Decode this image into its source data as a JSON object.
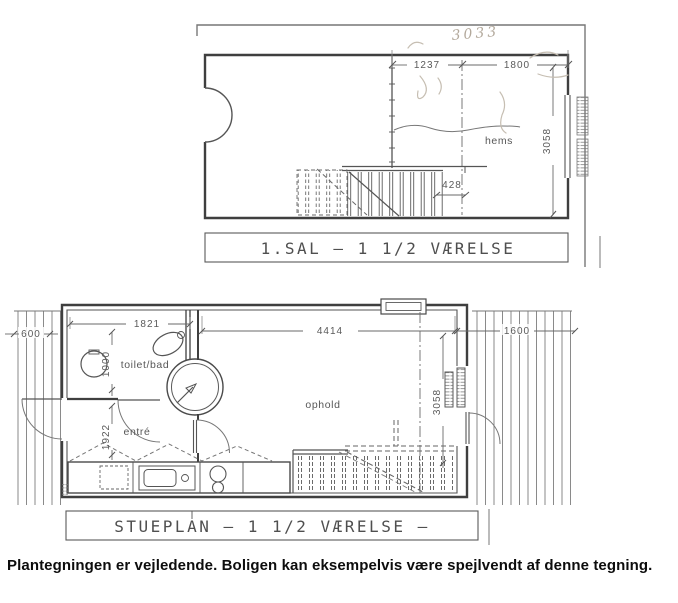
{
  "page": {
    "caption": "Plantegningen er vejledende. Boligen kan eksempelvis være spejlvendt af denne tegning.",
    "ink_color": "#3f3f3f",
    "pencil_color": "#b3a99c"
  },
  "first_floor_plan": {
    "title": "1.SAL – 1 1/2 VÆRELSE",
    "room_labels": {
      "loft": "hems"
    },
    "dimensions": {
      "loft_width_left": "1237",
      "loft_width_right": "1800",
      "loft_depth": "3058",
      "stair_offset": "428"
    },
    "handwritten_note": "3033"
  },
  "ground_floor_plan": {
    "title": "STUEPLAN – 1 1/2 VÆRELSE –",
    "room_labels": {
      "bathroom": "toilet/bad",
      "hall": "entré",
      "living_room": "ophold"
    },
    "dimensions": {
      "bathroom_width": "1821",
      "bathroom_depth": "1000",
      "hall_depth": "1922",
      "living_width": "4414",
      "living_depth": "3058",
      "left_terrace_width": "600",
      "right_terrace_width": "1600"
    }
  }
}
